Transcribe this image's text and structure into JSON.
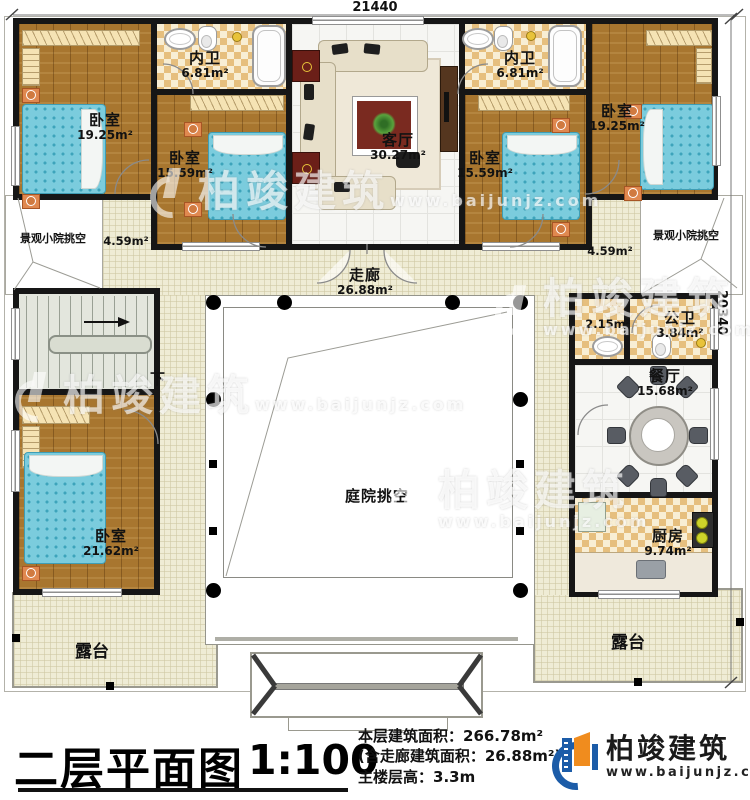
{
  "dimensions": {
    "top": "21440",
    "right": "20340"
  },
  "watermark": {
    "brand": "柏竣建筑",
    "url": "www.baijunjz.com"
  },
  "rooms": {
    "bedroom_top_left": {
      "label": "卧室",
      "area": "19.25m²"
    },
    "bath_inner_left": {
      "label": "内卫",
      "area": "6.81m²"
    },
    "living_room": {
      "label": "客厅",
      "area": "30.27m²"
    },
    "bath_inner_right": {
      "label": "内卫",
      "area": "6.81m²"
    },
    "bedroom_top_right": {
      "label": "卧室",
      "area": "19.25m²"
    },
    "bedroom_mid_left": {
      "label": "卧室",
      "area": "15.59m²"
    },
    "bedroom_mid_right": {
      "label": "卧室",
      "area": "15.59m²"
    },
    "yard_left": {
      "label": "景观小院挑空",
      "area": "4.59m²"
    },
    "yard_right": {
      "label": "景观小院挑空",
      "area": "4.59m²"
    },
    "corridor": {
      "label": "走廊",
      "area": "26.88m²"
    },
    "stairs": {
      "down_label": "下"
    },
    "wash_room": {
      "area": "2.15m²"
    },
    "public_bath": {
      "label": "公卫",
      "area": "3.84m²"
    },
    "dining_room": {
      "label": "餐厅",
      "area": "15.68m²"
    },
    "kitchen": {
      "label": "厨房",
      "area": "9.74m²"
    },
    "bedroom_bottom_left": {
      "label": "卧室",
      "area": "21.62m²"
    },
    "courtyard": {
      "label": "庭院挑空"
    },
    "terrace_left": {
      "label": "露台"
    },
    "terrace_right": {
      "label": "露台"
    }
  },
  "footer": {
    "plan_title": "二层平面图",
    "scale": "1:100",
    "stat_line1": "本层建筑面积：266.78m²",
    "stat_line2": "(含走廊建筑面积：26.88m²)",
    "stat_line3": "主楼层高：3.3m",
    "brand_name": "柏竣建筑",
    "brand_url": "www.baijunjz.com"
  },
  "colors": {
    "wall": "#161616",
    "wood": "#a8762f",
    "bed": "#7bccdd",
    "checker": "#e6bf7e",
    "cream": "#efecd5",
    "brand_blue": "#1c5ca8",
    "brand_orange": "#f08c1e"
  }
}
